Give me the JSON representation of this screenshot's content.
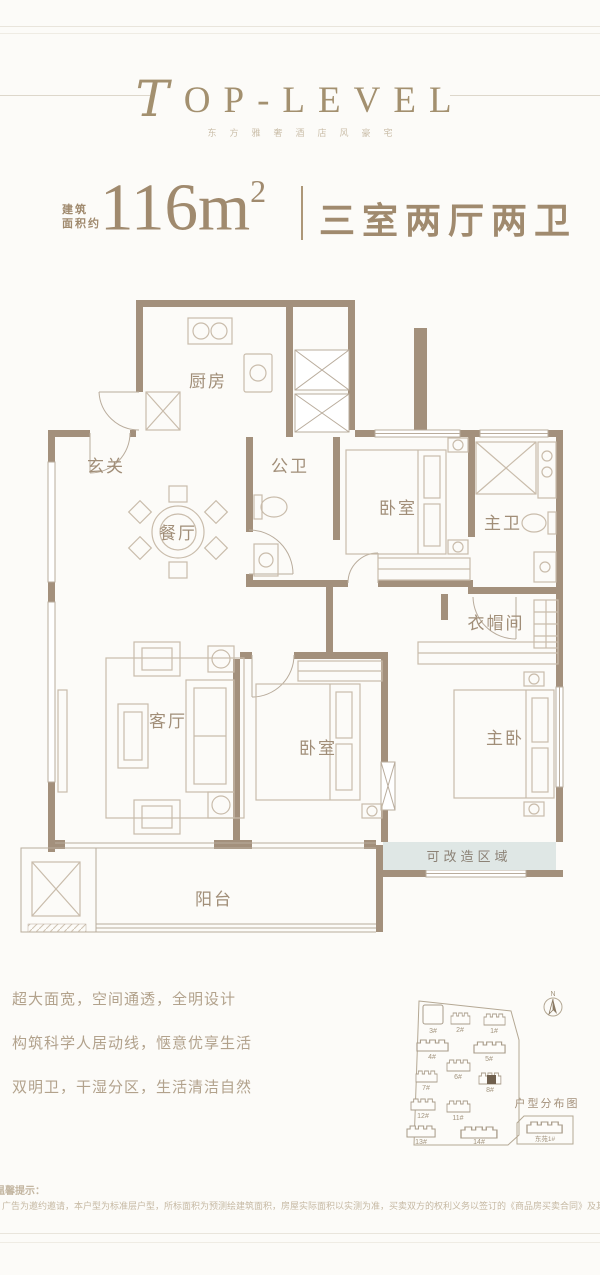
{
  "header": {
    "brand_initial": "T",
    "brand_rest": "OP-LEVEL",
    "subtitle": "东方雅奢酒店风豪宅"
  },
  "title": {
    "area_label_line1": "建筑",
    "area_label_line2": "面积约",
    "area_value": "116m",
    "area_sup": "2",
    "layout_name": "三室两厅两卫"
  },
  "floorplan": {
    "rooms": {
      "kitchen": "厨房",
      "entrance": "玄关",
      "dining": "餐厅",
      "public_bath": "公卫",
      "bedroom_top": "卧室",
      "master_bath": "主卫",
      "cloakroom": "衣帽间",
      "living": "客厅",
      "bedroom_mid": "卧室",
      "master_bedroom": "主卧",
      "renovatable_zone": "可改造区域",
      "balcony": "阳台"
    }
  },
  "features": [
    "超大面宽，空间通透，全明设计",
    "构筑科学人居动线，惬意优享生活",
    "双明卫，干湿分区，生活清洁自然"
  ],
  "sitemap": {
    "title": "户型分布图",
    "compass_n": "N",
    "buildings": [
      "3#",
      "2#",
      "1#",
      "4#",
      "5#",
      "6#",
      "7#",
      "8#",
      "12#",
      "11#",
      "13#",
      "14#"
    ],
    "highlighted_building": "8#",
    "annex": "东苑1#"
  },
  "disclaimer": {
    "title": "温馨提示：",
    "body": "广告为邀约邀请，本户型为标准层户型，所标面积为预测绘建筑面积，房屋实际面积以实测为准，买卖双方的权利义务以签订的《商品房买卖合同》及其附件为准。"
  },
  "colors": {
    "brand": "#a08a6e",
    "wall": "#a3907c",
    "renovatable_fill": "#dfe7e5"
  }
}
